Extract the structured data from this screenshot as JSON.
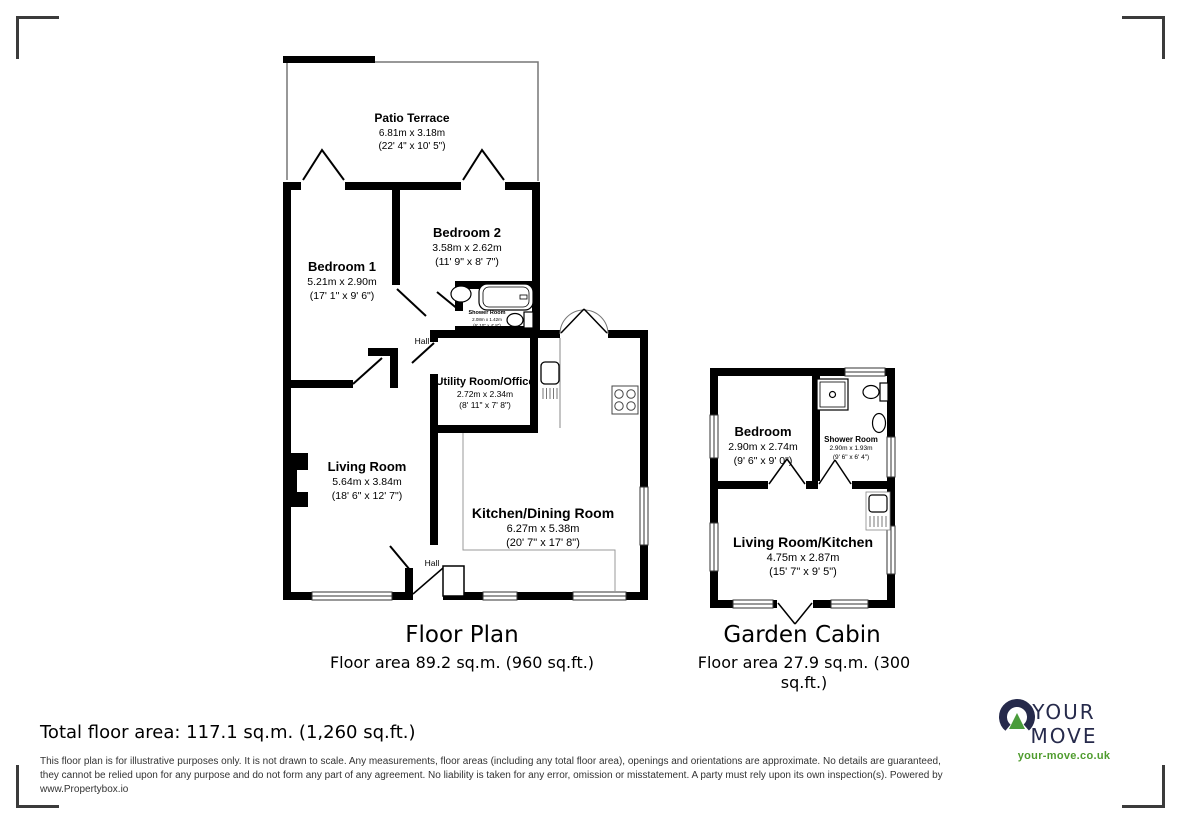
{
  "main_plan": {
    "title": "Floor Plan",
    "area": "Floor area 89.2 sq.m. (960 sq.ft.)",
    "rooms": {
      "patio_terrace": {
        "name": "Patio Terrace",
        "metric": "6.81m x 3.18m",
        "imperial": "(22' 4\" x 10' 5\")"
      },
      "bedroom1": {
        "name": "Bedroom 1",
        "metric": "5.21m x 2.90m",
        "imperial": "(17' 1\" x 9' 6\")"
      },
      "bedroom2": {
        "name": "Bedroom 2",
        "metric": "3.58m x 2.62m",
        "imperial": "(11' 9\" x 8' 7\")"
      },
      "shower_room": {
        "name": "Shower Room",
        "metric": "2.08m x 1.42m",
        "imperial": "(6' 10\" x 4' 8\")"
      },
      "utility": {
        "name": "Utility Room/Office",
        "metric": "2.72m x 2.34m",
        "imperial": "(8' 11\" x 7' 8\")"
      },
      "living_room": {
        "name": "Living Room",
        "metric": "5.64m x 3.84m",
        "imperial": "(18' 6\" x 12' 7\")"
      },
      "kitchen_dining": {
        "name": "Kitchen/Dining Room",
        "metric": "6.27m x 5.38m",
        "imperial": "(20' 7\" x 17' 8\")"
      },
      "hall_upper": {
        "name": "Hall"
      },
      "hall_lower": {
        "name": "Hall"
      }
    }
  },
  "cabin_plan": {
    "title": "Garden Cabin",
    "area": "Floor area 27.9 sq.m. (300 sq.ft.)",
    "rooms": {
      "bedroom": {
        "name": "Bedroom",
        "metric": "2.90m x 2.74m",
        "imperial": "(9' 6\" x 9' 0\")"
      },
      "shower_room": {
        "name": "Shower Room",
        "metric": "2.90m x 1.93m",
        "imperial": "(9' 6\" x 6' 4\")"
      },
      "living_kitchen": {
        "name": "Living Room/Kitchen",
        "metric": "4.75m x 2.87m",
        "imperial": "(15' 7\" x 9' 5\")"
      }
    }
  },
  "footer": {
    "total_area": "Total floor area: 117.1 sq.m. (1,260 sq.ft.)",
    "disclaimer": "This floor plan is for illustrative purposes only. It is not drawn to scale. Any measurements, floor areas (including any total floor area), openings and orientations are approximate. No details are guaranteed, they cannot be relied upon for any purpose and do not form any part of any agreement. No liability is taken for any error, omission or misstatement. A party must rely upon its own inspection(s). Powered by www.Propertybox.io"
  },
  "logo": {
    "brand": "YOUR MOVE",
    "url": "your-move.co.uk",
    "navy": "#262a4b",
    "green": "#4a9c3b"
  }
}
